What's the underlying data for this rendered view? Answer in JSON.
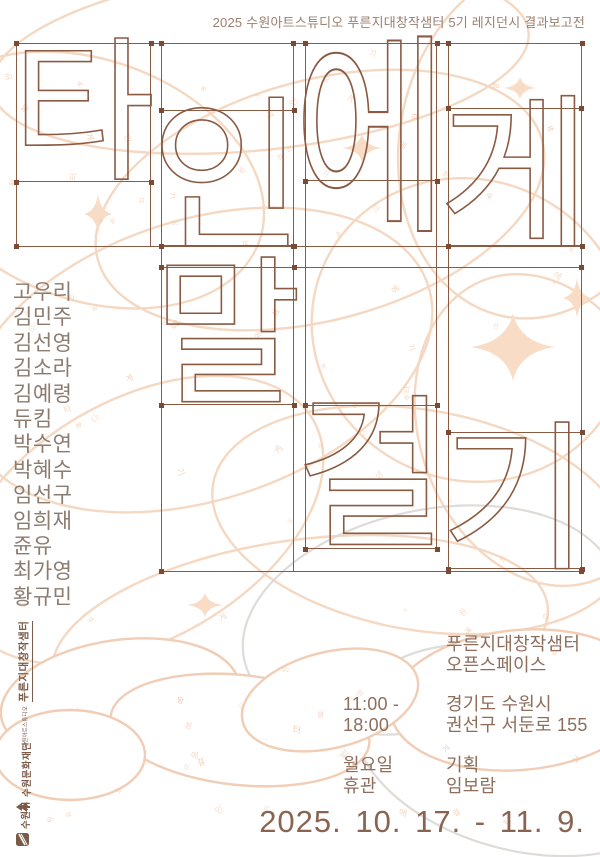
{
  "poster": {
    "note": "2025 수원아트스튜디오 푸른지대창작샘터 5기 레지던시 결과보고전",
    "letters": [
      "타",
      "인",
      "에",
      "게",
      "말",
      "걸",
      "기"
    ],
    "artists": [
      "고우리",
      "김민주",
      "김선영",
      "김소라",
      "김예령",
      "듀킴",
      "박수연",
      "박혜수",
      "임선구",
      "임희재",
      "쥰유",
      "최가영",
      "황규민"
    ],
    "venue": {
      "name_line1": "푸른지대창작샘터",
      "name_line2": "오픈스페이스",
      "hours_line1": "11:00 -",
      "hours_line2": "18:00",
      "address_line1": "경기도 수원시",
      "address_line2": "권선구 서둔로 155",
      "closed_line1": "월요일",
      "closed_line2": "휴관",
      "curator_label": "기획",
      "curator_name": "임보람"
    },
    "dates": "2025. 10. 17. - 11. 9.",
    "logos": {
      "studio_small": "수원아트스튜디오",
      "studio": "푸른지대창작샘터",
      "foundation": "수원문화재단",
      "city": "수원시"
    },
    "colors": {
      "line": "#8a5a42",
      "handle": "#7a4a35",
      "note_text": "#9b8070",
      "artist_text": "#8c7b6f",
      "info_text": "#8e6e5b",
      "date_text": "#8a6450",
      "logo_text": "#7a5a48",
      "blob_stroke": "#f3d2b8",
      "blob_fill": "#f8dcc6",
      "gray_stroke": "#dcd8d4"
    }
  }
}
